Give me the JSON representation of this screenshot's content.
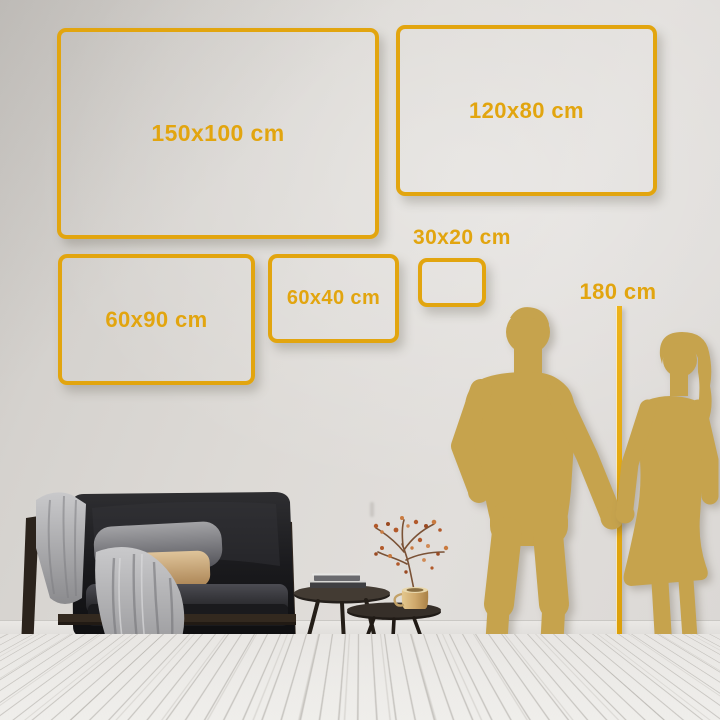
{
  "size_guide": {
    "frames": [
      {
        "id": "150x100",
        "label": "150x100 cm"
      },
      {
        "id": "120x80",
        "label": "120x80 cm"
      },
      {
        "id": "60x90",
        "label": "60x90 cm"
      },
      {
        "id": "60x40",
        "label": "60x40 cm"
      },
      {
        "id": "30x20",
        "label": "30x20 cm"
      }
    ],
    "height_reference": {
      "label": "180 cm"
    }
  },
  "colors": {
    "accent": "#E2A50F",
    "silhouette": "#C6A34D",
    "wall": "#DCD9D5",
    "floor": "#F1F0ED"
  }
}
